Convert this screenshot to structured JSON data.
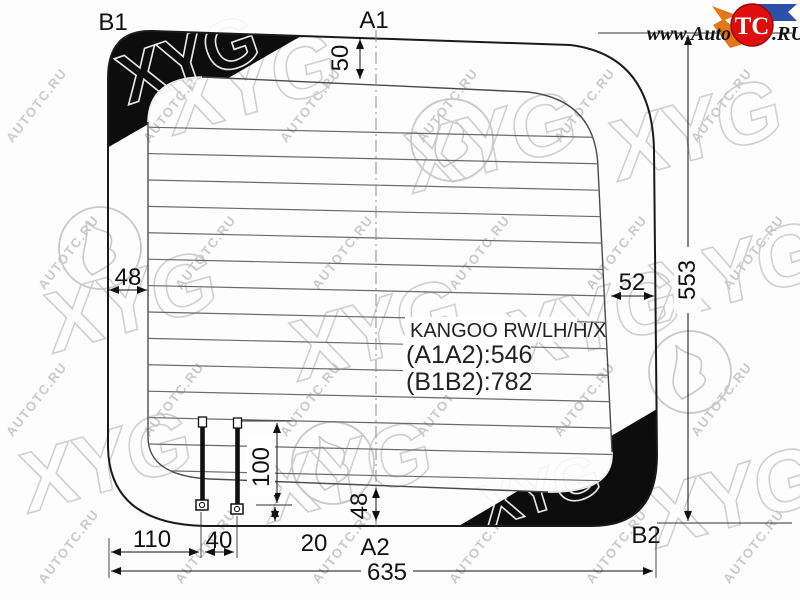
{
  "glass": {
    "model": "KANGOO RW/LH/H/X",
    "dim_a": "(A1A2):546",
    "dim_b": "(B1B2):782"
  },
  "points": {
    "b1": "B1",
    "a1": "A1",
    "a2": "A2",
    "b2": "B2"
  },
  "dimensions": {
    "top_inset": "50",
    "left_inset": "48",
    "right_inset": "52",
    "height": "553",
    "left_offset": "110",
    "bolt_spacing": "40",
    "extra_offset": "20",
    "bolt_length": "100",
    "bottom_inset": "48",
    "width": "635"
  },
  "logo": {
    "www": "www.Auto",
    "tc": "TC",
    "ru": ".RU"
  },
  "watermark": {
    "site": "AUTOTC.RU",
    "brand": "XYG"
  },
  "colors": {
    "line": "#1a1a1a",
    "inner_line": "#444444",
    "heater_line": "#6a6a6a",
    "wedge": "#0d0d0d",
    "logo_red": "#e00d0d",
    "logo_orange": "#e07818",
    "logo_blue": "#2b52a8",
    "watermark_gray": "#c0c0c0"
  }
}
